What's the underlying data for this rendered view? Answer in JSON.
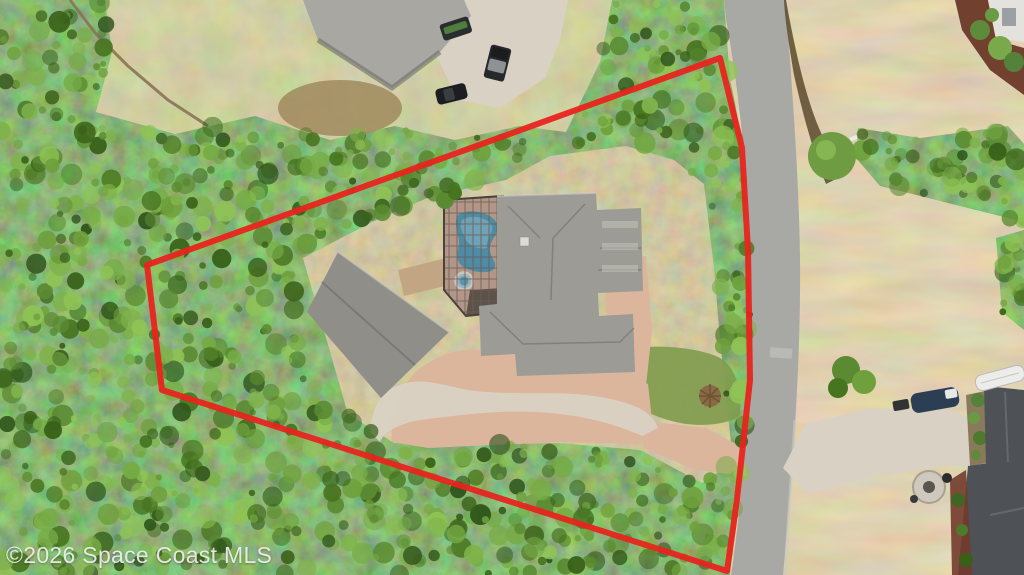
{
  "watermark": {
    "text": "©2026 Space Coast MLS"
  },
  "annotation": {
    "boundary_color": "#e8241f",
    "boundary_description": "red outline around wooded lot"
  },
  "palette": {
    "forest": "#4e7a2e",
    "dry_grass": "#bfa273",
    "lawn": "#a6a169",
    "asphalt": "#a8a8a5",
    "concrete": "#d9d2c4",
    "pavers": "#dcb59d",
    "roof_main": "#9c9b96",
    "roof_garage": "#8f8e89",
    "roof_top_neighbor": "#a8a7a2",
    "roof_bottom_neighbor": "#4e5156",
    "pool_water": "#4f8ba3",
    "pool_deck": "#b29789"
  }
}
